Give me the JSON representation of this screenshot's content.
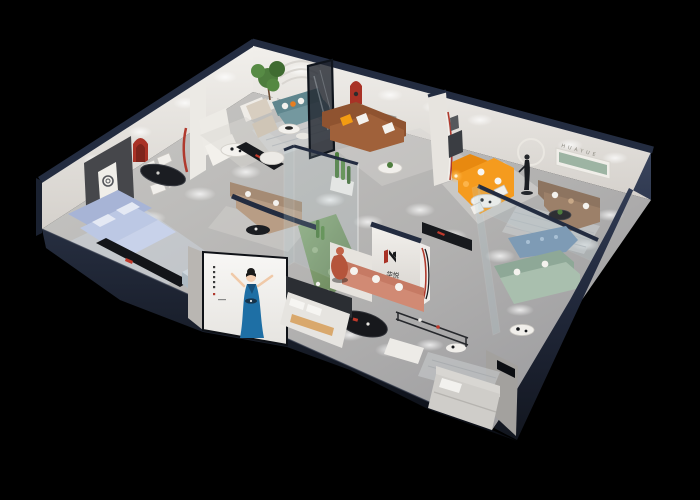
{
  "brand": {
    "logo_cn": "华悦",
    "wall_letters": "HUAYUE"
  },
  "palette": {
    "background": "#000000",
    "wall_top_navy": "#232c40",
    "wall_face": "#e9e6e1",
    "floor_gray": "#b9b8b6",
    "accent_red": "#a93226",
    "sofa_orange": "#f59b1e",
    "sofa_brown": "#a0613a",
    "sofa_teal": "#74989f",
    "sofa_blue_light": "#bcc8e4",
    "sofa_salmon": "#d18a74",
    "sofa_sage": "#a9bfae",
    "sofa_taupe": "#9c8069",
    "plant_green": "#4e7d3e",
    "atrium_floor": "#7f9f72",
    "poster_dress_blue": "#1e6fa5",
    "glass_frame_dark": "#10151d"
  }
}
